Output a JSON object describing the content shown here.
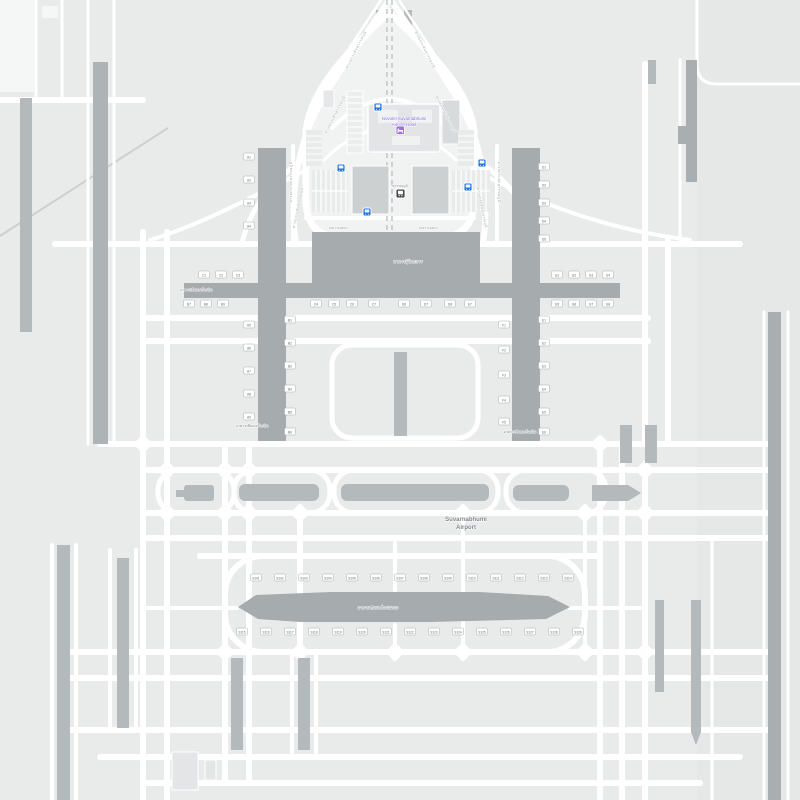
{
  "meta": {
    "place": "Suvarnabhumi Airport map"
  },
  "colors": {
    "bg": "#e9ebeb",
    "bg_right": "#e6e8e8",
    "landside": "#f1f2f2",
    "road": "#ffffff",
    "pavement": "#b4b9bb",
    "runway": "#a9aeb1",
    "terminal": "#a6abad",
    "building": "#dfe2e3",
    "building_dark": "#cdd0d1",
    "label": "#7d8488",
    "road_label": "#9aa0a3",
    "poi_purple": "#7e62e0",
    "hotel_icon": "#9d6fe0",
    "transit_blue": "#1a73e8",
    "station_dark": "#40474e",
    "badge_text": "#5f6368",
    "badge_border": "#a5aaad"
  },
  "labels": {
    "airport": {
      "line1": "Suvarnabhumi",
      "line2": "Airport"
    },
    "hotel": {
      "line1": "Novotel Suvarnabhumi",
      "line2": "Airport Hotel"
    },
    "station": "สุวรรณภูมิ",
    "terminal": "อาคารผู้โดยสาร",
    "concourse": "อาคารเทียบเครื่องบิน",
    "satellite": "อาคารเทียบเครื่องบินรอง",
    "parking": "อาคารจอดรถ",
    "road_name": "ทางยกระดับสุวรรณภูมิ"
  },
  "road_labels": [
    {
      "x": 336,
      "y": 115,
      "rot": -63
    },
    {
      "x": 445,
      "y": 115,
      "rot": 63
    },
    {
      "x": 357,
      "y": 50,
      "rot": -63
    },
    {
      "x": 424,
      "y": 50,
      "rot": 63
    },
    {
      "x": 299,
      "y": 208,
      "rot": -78
    },
    {
      "x": 481,
      "y": 208,
      "rot": 78
    },
    {
      "x": 292,
      "y": 182,
      "rot": -90
    },
    {
      "x": 498,
      "y": 182,
      "rot": 90
    }
  ],
  "transit_stops": [
    {
      "x": 374,
      "y": 103
    },
    {
      "x": 337,
      "y": 164
    },
    {
      "x": 478,
      "y": 159
    },
    {
      "x": 464,
      "y": 183
    },
    {
      "x": 363,
      "y": 208
    }
  ],
  "station_icon": {
    "x": 396,
    "y": 189
  },
  "hotel_icon": {
    "x": 396,
    "y": 126
  },
  "gate_badges": [
    {
      "x": 249,
      "y": 157,
      "t": "A1"
    },
    {
      "x": 249,
      "y": 180,
      "t": "A2"
    },
    {
      "x": 249,
      "y": 203,
      "t": "A3"
    },
    {
      "x": 249,
      "y": 226,
      "t": "A4"
    },
    {
      "x": 249,
      "y": 325,
      "t": "A5"
    },
    {
      "x": 249,
      "y": 348,
      "t": "A6"
    },
    {
      "x": 249,
      "y": 371,
      "t": "A7"
    },
    {
      "x": 249,
      "y": 394,
      "t": "A8"
    },
    {
      "x": 249,
      "y": 417,
      "t": "A9"
    },
    {
      "x": 290,
      "y": 320,
      "t": "B1"
    },
    {
      "x": 290,
      "y": 343,
      "t": "B2"
    },
    {
      "x": 290,
      "y": 366,
      "t": "B3"
    },
    {
      "x": 290,
      "y": 389,
      "t": "B4"
    },
    {
      "x": 290,
      "y": 412,
      "t": "B5"
    },
    {
      "x": 290,
      "y": 432,
      "t": "B6"
    },
    {
      "x": 504,
      "y": 325,
      "t": "F1"
    },
    {
      "x": 504,
      "y": 350,
      "t": "F2"
    },
    {
      "x": 504,
      "y": 375,
      "t": "F3"
    },
    {
      "x": 504,
      "y": 400,
      "t": "F4"
    },
    {
      "x": 504,
      "y": 422,
      "t": "F5"
    },
    {
      "x": 544,
      "y": 167,
      "t": "D1"
    },
    {
      "x": 544,
      "y": 185,
      "t": "D2"
    },
    {
      "x": 544,
      "y": 203,
      "t": "D3"
    },
    {
      "x": 544,
      "y": 221,
      "t": "D4"
    },
    {
      "x": 544,
      "y": 239,
      "t": "D5"
    },
    {
      "x": 544,
      "y": 320,
      "t": "E1"
    },
    {
      "x": 544,
      "y": 343,
      "t": "E2"
    },
    {
      "x": 544,
      "y": 366,
      "t": "E3"
    },
    {
      "x": 544,
      "y": 389,
      "t": "E4"
    },
    {
      "x": 544,
      "y": 412,
      "t": "E5"
    },
    {
      "x": 544,
      "y": 432,
      "t": "E6"
    },
    {
      "x": 204,
      "y": 275,
      "t": "C1"
    },
    {
      "x": 221,
      "y": 275,
      "t": "C2"
    },
    {
      "x": 238,
      "y": 275,
      "t": "C3"
    },
    {
      "x": 557,
      "y": 275,
      "t": "G1"
    },
    {
      "x": 574,
      "y": 275,
      "t": "G2"
    },
    {
      "x": 591,
      "y": 275,
      "t": "G3"
    },
    {
      "x": 608,
      "y": 275,
      "t": "G4"
    },
    {
      "x": 189,
      "y": 304,
      "t": "B7"
    },
    {
      "x": 206,
      "y": 304,
      "t": "B8"
    },
    {
      "x": 223,
      "y": 304,
      "t": "B9"
    },
    {
      "x": 316,
      "y": 304,
      "t": "C4"
    },
    {
      "x": 334,
      "y": 304,
      "t": "C5"
    },
    {
      "x": 352,
      "y": 304,
      "t": "C6"
    },
    {
      "x": 374,
      "y": 304,
      "t": "C7"
    },
    {
      "x": 404,
      "y": 304,
      "t": "D6"
    },
    {
      "x": 426,
      "y": 304,
      "t": "D7"
    },
    {
      "x": 450,
      "y": 304,
      "t": "D8"
    },
    {
      "x": 470,
      "y": 304,
      "t": "E7"
    },
    {
      "x": 557,
      "y": 304,
      "t": "G5"
    },
    {
      "x": 574,
      "y": 304,
      "t": "G6"
    },
    {
      "x": 591,
      "y": 304,
      "t": "G7"
    },
    {
      "x": 608,
      "y": 304,
      "t": "G8"
    },
    {
      "x": 256,
      "y": 578,
      "t": "S101"
    },
    {
      "x": 280,
      "y": 578,
      "t": "S102"
    },
    {
      "x": 304,
      "y": 578,
      "t": "S103"
    },
    {
      "x": 328,
      "y": 578,
      "t": "S104"
    },
    {
      "x": 352,
      "y": 578,
      "t": "S105"
    },
    {
      "x": 376,
      "y": 578,
      "t": "S106"
    },
    {
      "x": 400,
      "y": 578,
      "t": "S107"
    },
    {
      "x": 424,
      "y": 578,
      "t": "S108"
    },
    {
      "x": 448,
      "y": 578,
      "t": "S109"
    },
    {
      "x": 472,
      "y": 578,
      "t": "S110"
    },
    {
      "x": 496,
      "y": 578,
      "t": "S111"
    },
    {
      "x": 520,
      "y": 578,
      "t": "S112"
    },
    {
      "x": 544,
      "y": 578,
      "t": "S113"
    },
    {
      "x": 568,
      "y": 578,
      "t": "S114"
    },
    {
      "x": 242,
      "y": 632,
      "t": "S115"
    },
    {
      "x": 266,
      "y": 632,
      "t": "S116"
    },
    {
      "x": 290,
      "y": 632,
      "t": "S117"
    },
    {
      "x": 314,
      "y": 632,
      "t": "S118"
    },
    {
      "x": 338,
      "y": 632,
      "t": "S119"
    },
    {
      "x": 362,
      "y": 632,
      "t": "S120"
    },
    {
      "x": 386,
      "y": 632,
      "t": "S121"
    },
    {
      "x": 410,
      "y": 632,
      "t": "S122"
    },
    {
      "x": 434,
      "y": 632,
      "t": "S123"
    },
    {
      "x": 458,
      "y": 632,
      "t": "S124"
    },
    {
      "x": 482,
      "y": 632,
      "t": "S125"
    },
    {
      "x": 506,
      "y": 632,
      "t": "S126"
    },
    {
      "x": 530,
      "y": 632,
      "t": "S127"
    },
    {
      "x": 554,
      "y": 632,
      "t": "S128"
    },
    {
      "x": 578,
      "y": 632,
      "t": "S129"
    }
  ]
}
